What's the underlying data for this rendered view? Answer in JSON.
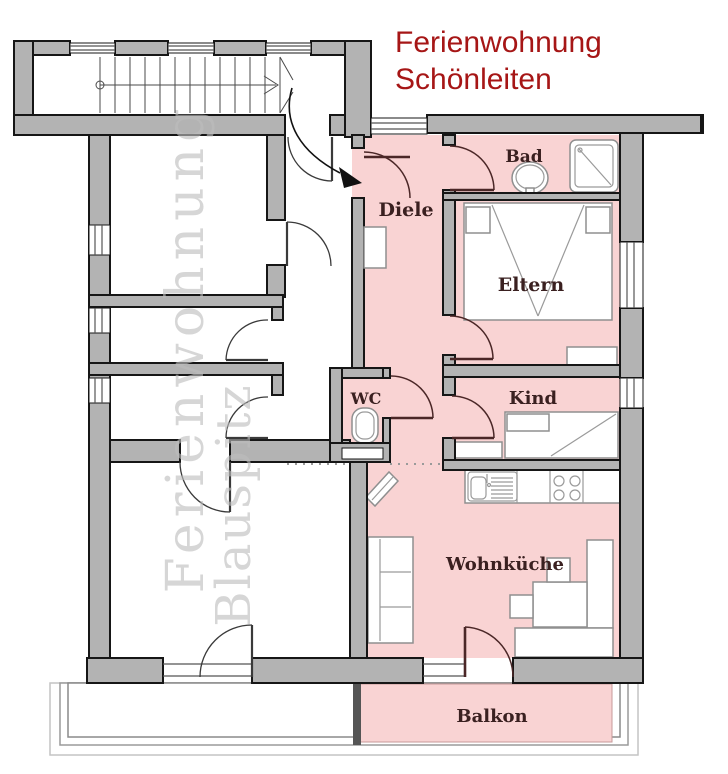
{
  "title": {
    "line1": "Ferienwohnung",
    "line2": "Schönleiten"
  },
  "watermark": {
    "line1": "Ferienwohnung",
    "line2": "Blauspitz"
  },
  "rooms": {
    "diele": "Diele",
    "bad": "Bad",
    "eltern": "Eltern",
    "wc": "WC",
    "kind": "Kind",
    "wohnkueche": "Wohnküche",
    "balkon": "Balkon"
  },
  "colors": {
    "title": "#a61616",
    "watermark": "#bdbdbd",
    "room_label": "#3a2020",
    "wall_gray": "#b3b3b3",
    "apartment_pink": "#f9d3d3"
  }
}
